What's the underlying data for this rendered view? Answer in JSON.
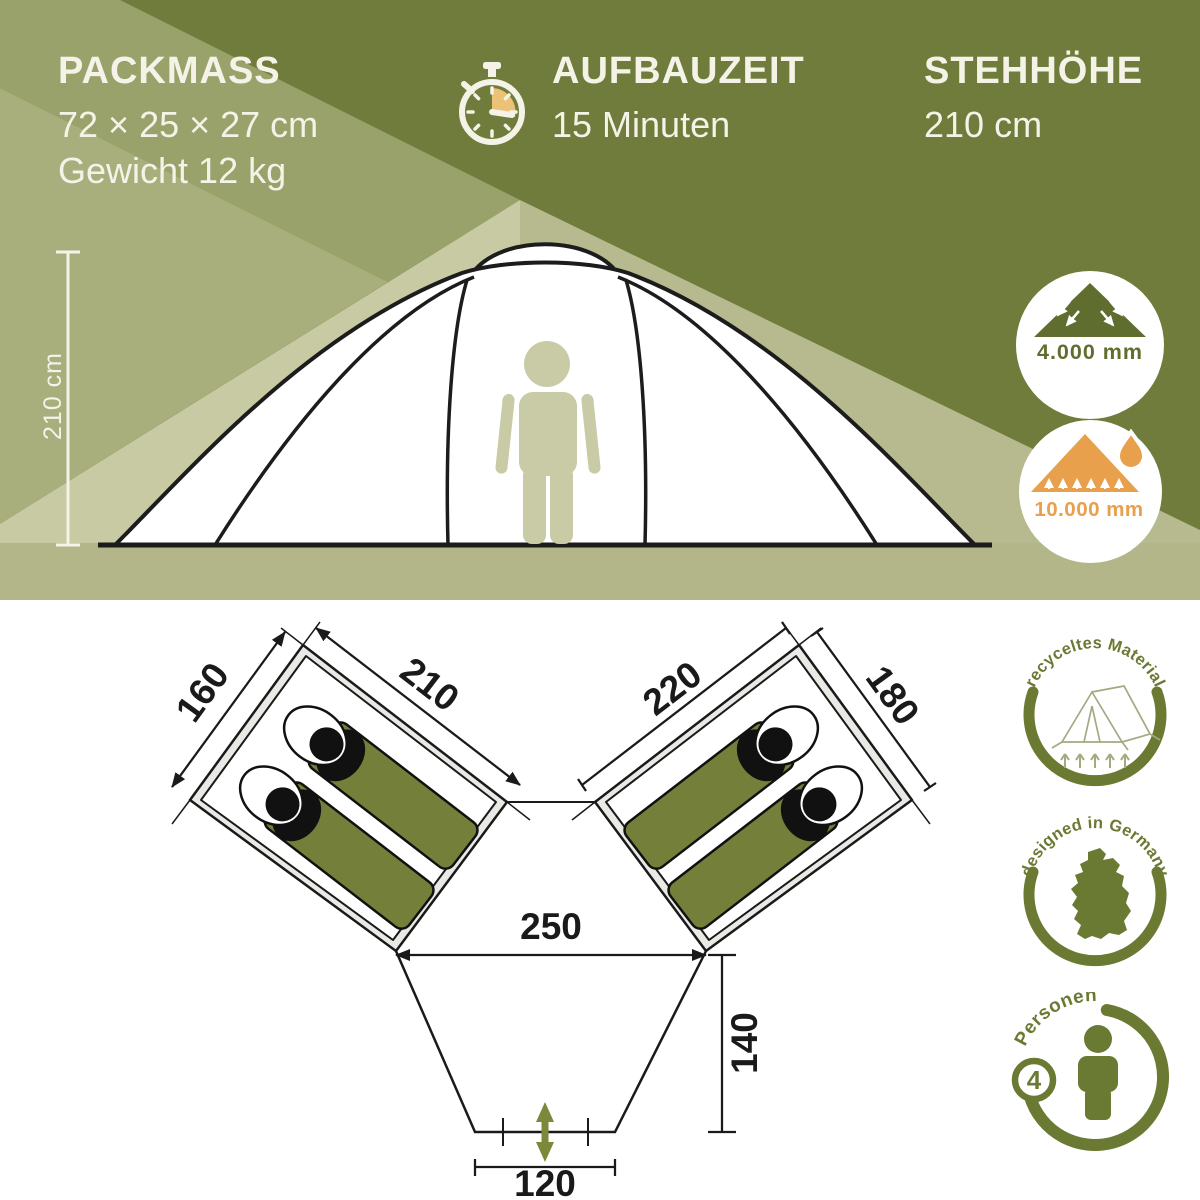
{
  "brand_colors": {
    "olive_dark": "#6f7c3b",
    "olive_band": "#9aa26b",
    "olive_badge": "#6b7a33",
    "orange": "#e8a04c",
    "cream_text": "#f5f3e8",
    "bag_green": "#74803a",
    "entrance_arrow_green": "#7a8a3a"
  },
  "top_specs": {
    "packmass": {
      "title": "PACKMASS",
      "dimensions": "72 × 25 × 27 cm",
      "weight": "Gewicht 12 kg"
    },
    "aufbauzeit": {
      "title": "AUFBAUZEIT",
      "value": "15 Minuten"
    },
    "stehhoehe": {
      "title": "STEHHÖHE",
      "value": "210 cm"
    }
  },
  "side_view": {
    "height_marker": "210 cm"
  },
  "water_badges": {
    "flysheet": "4.000 mm",
    "groundsheet": "10.000 mm"
  },
  "floorplan": {
    "left_cabin_width": "160",
    "left_cabin_length": "210",
    "right_cabin_length": "220",
    "right_cabin_width": "180",
    "center_width": "250",
    "porch_depth": "140",
    "entrance_width": "120"
  },
  "feature_badges": {
    "recycled_material": "recyceltes Material",
    "designed_in_germany": "designed in Germany",
    "persons_label": "Personen",
    "persons_count": "4"
  }
}
